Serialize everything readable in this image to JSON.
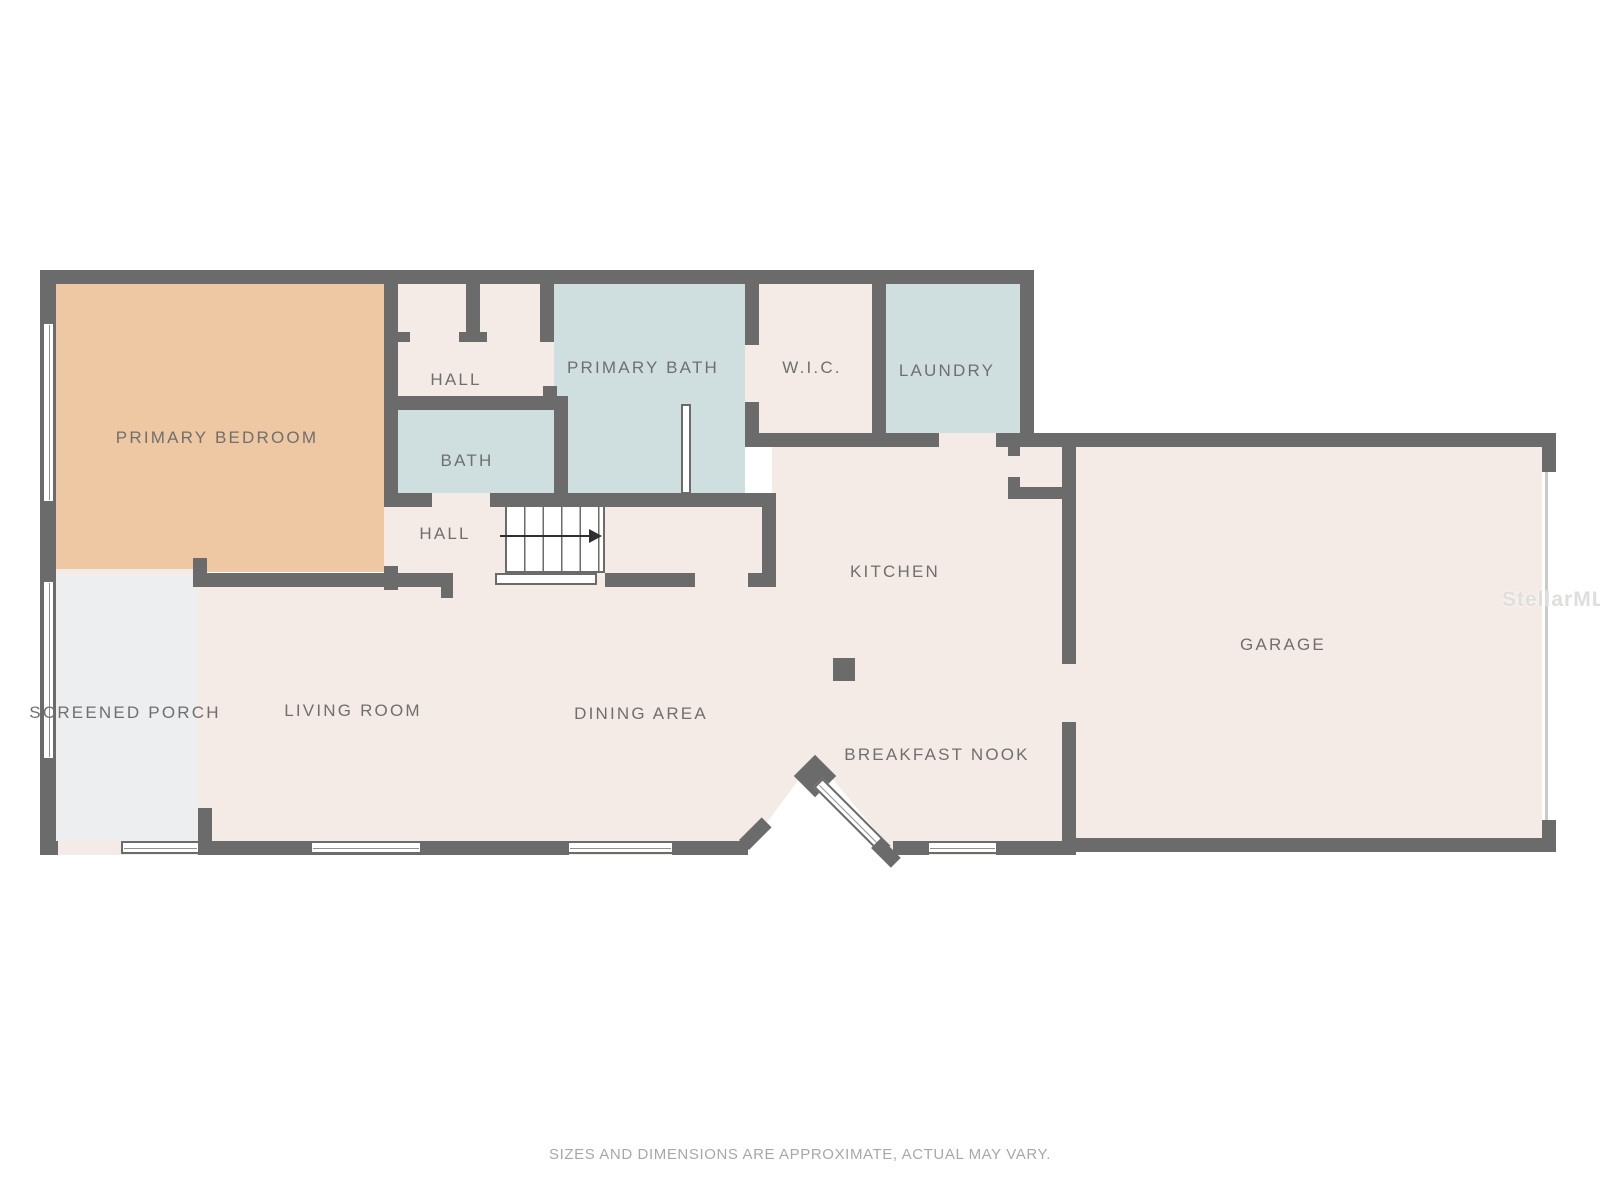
{
  "rooms": [
    {
      "id": "primary-bedroom",
      "label": "PRIMARY BEDROOM"
    },
    {
      "id": "hall-upper",
      "label": "HALL"
    },
    {
      "id": "primary-bath",
      "label": "PRIMARY BATH"
    },
    {
      "id": "wic",
      "label": "W.I.C."
    },
    {
      "id": "laundry",
      "label": "LAUNDRY"
    },
    {
      "id": "bath",
      "label": "BATH"
    },
    {
      "id": "hall-lower",
      "label": "HALL"
    },
    {
      "id": "kitchen",
      "label": "KITCHEN"
    },
    {
      "id": "garage",
      "label": "GARAGE"
    },
    {
      "id": "screened-porch",
      "label": "SCREENED PORCH"
    },
    {
      "id": "living-room",
      "label": "LIVING ROOM"
    },
    {
      "id": "dining-area",
      "label": "DINING AREA"
    },
    {
      "id": "breakfast-nook",
      "label": "BREAKFAST NOOK"
    }
  ],
  "stairs": {
    "direction": "up",
    "arrow": "right"
  },
  "watermark": {
    "text": "StellarMLS"
  },
  "footer": {
    "disclaimer": "SIZES AND DIMENSIONS ARE APPROXIMATE, ACTUAL MAY VARY."
  },
  "colors": {
    "wall": "#6b6b6b",
    "floor": "#f5ebe6",
    "bedroom_fill": "#edc8a2",
    "bath_fill": "#cfdfe0",
    "porch_fill": "#eceef0",
    "label_text": "#6f6f6f",
    "footer_text": "#a5a8ab"
  }
}
